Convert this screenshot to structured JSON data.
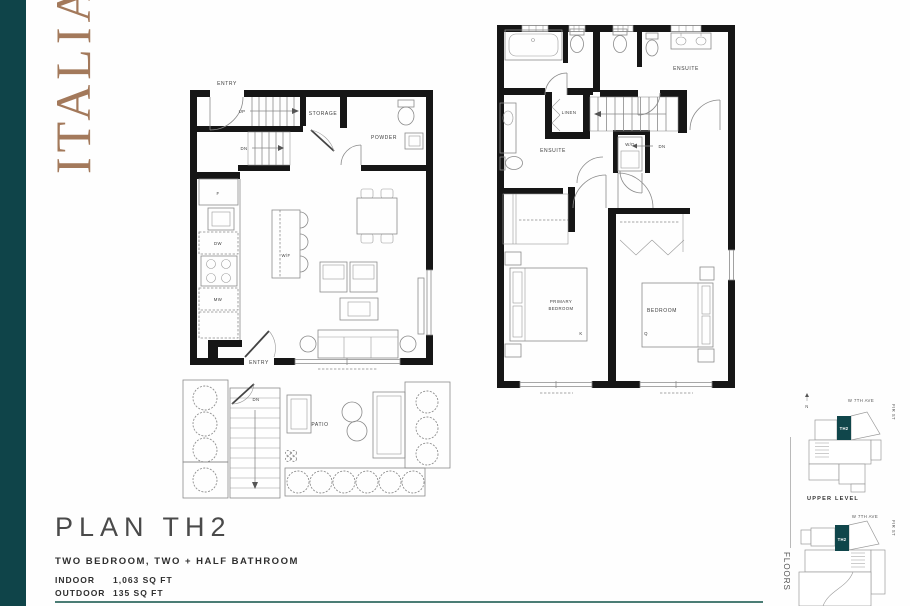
{
  "brand": {
    "name": "ITALIA",
    "color": "#a3795b"
  },
  "palette": {
    "sidebar_teal": "#0f4449",
    "keyplan_teal": "#10464b",
    "accent_rule": "#4b7d75",
    "wall": "#161616"
  },
  "plan": {
    "title": "PLAN TH2",
    "subtitle": "TWO BEDROOM, TWO + HALF BATHROOM",
    "specs": [
      {
        "label": "INDOOR",
        "value": "1,063 SQ FT"
      },
      {
        "label": "OUTDOOR",
        "value": "135 SQ FT"
      }
    ]
  },
  "main_level": {
    "labels": {
      "entry_top": "ENTRY",
      "up": "UP",
      "dn": "DN",
      "storage": "STORAGE",
      "powder": "POWDER",
      "fridge": "F",
      "dishwasher": "DW",
      "microwave": "MW",
      "wine_fridge": "W/F",
      "entry_bottom": "ENTRY",
      "patio_dn": "DN",
      "patio": "PATIO"
    }
  },
  "upper_level": {
    "labels": {
      "ensuite": "ENSUITE",
      "linen": "LINEN",
      "washer_dryer": "W/D",
      "dn": "DN",
      "primary_line1": "PRIMARY",
      "primary_line2": "BEDROOM",
      "bedroom": "BEDROOM",
      "king": "K",
      "queen": "Q"
    }
  },
  "keyplans": {
    "upper": {
      "north": "N",
      "avenue": "W 7TH AVE",
      "street": "FIR ST",
      "unit": "TH2",
      "caption": "UPPER LEVEL"
    },
    "lower": {
      "avenue": "W 7TH AVE",
      "street": "FIR ST",
      "unit": "TH2"
    },
    "side_label": "FLOORS"
  }
}
